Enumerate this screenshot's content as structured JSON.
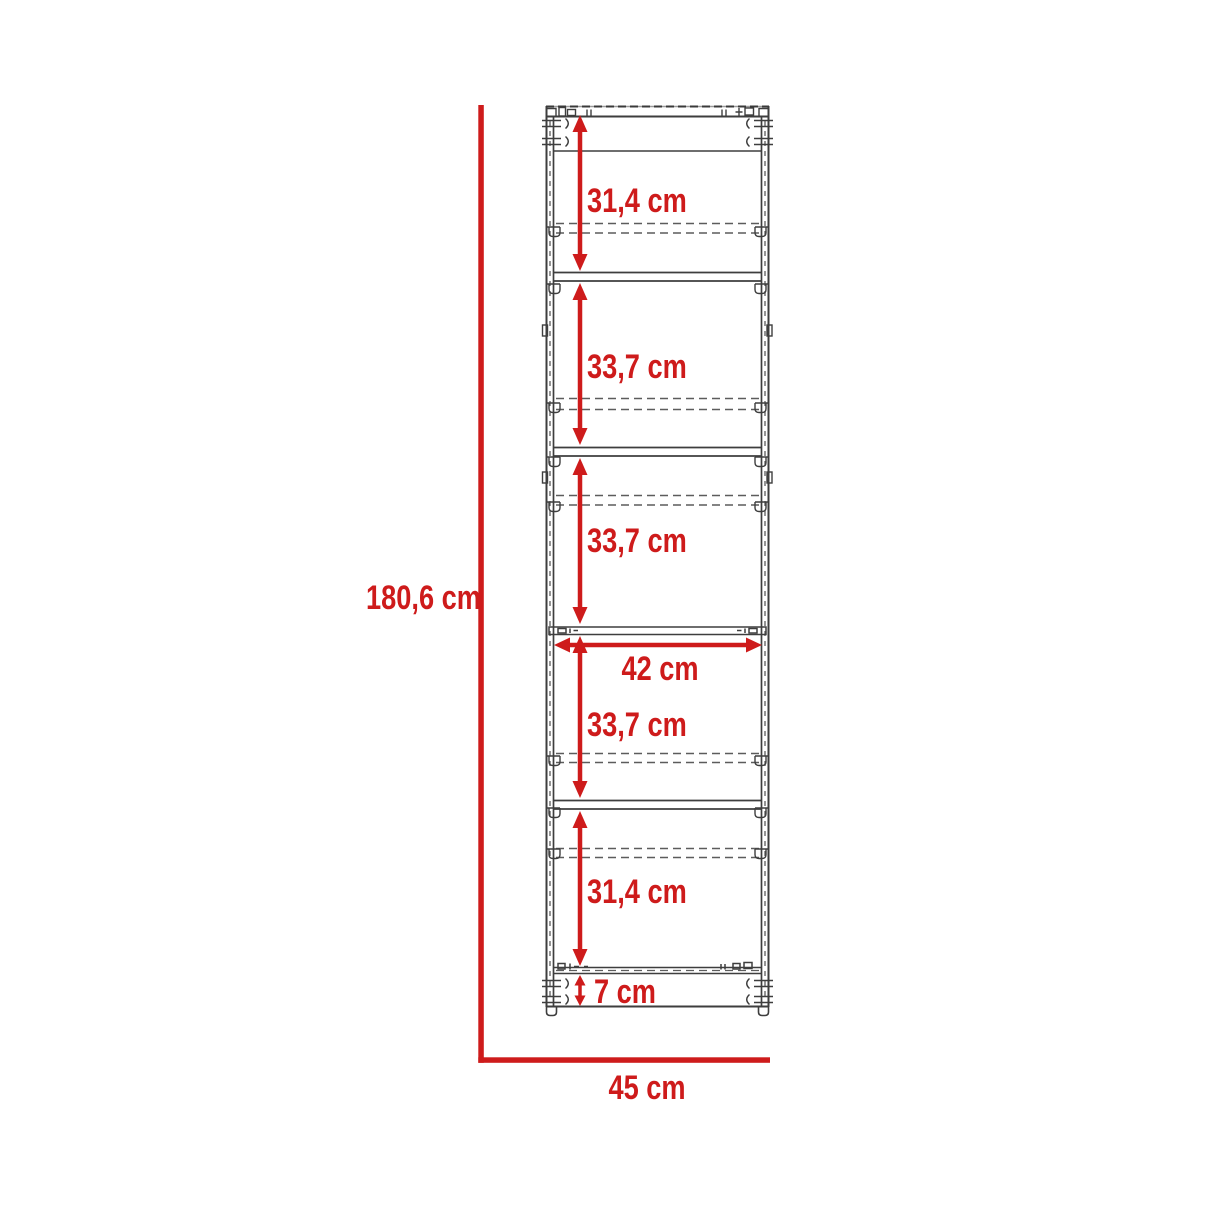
{
  "diagram": {
    "kind": "furniture-dimension-drawing",
    "subject": "tall cabinet front elevation",
    "unit": "cm",
    "overall_height": {
      "label": "180,6 cm",
      "value": 180.6
    },
    "overall_width": {
      "label": "45 cm",
      "value": 45
    },
    "interior_width": {
      "label": "42 cm",
      "value": 42
    },
    "plinth_height": {
      "label": "7 cm",
      "value": 7
    },
    "compartments": [
      {
        "name": "compartment-1",
        "label": "31,4 cm",
        "value": 31.4
      },
      {
        "name": "compartment-2",
        "label": "33,7 cm",
        "value": 33.7
      },
      {
        "name": "compartment-3",
        "label": "33,7 cm",
        "value": 33.7
      },
      {
        "name": "compartment-4",
        "label": "33,7 cm",
        "value": 33.7
      },
      {
        "name": "compartment-5",
        "label": "31,4 cm",
        "value": 31.4
      }
    ],
    "colors": {
      "dimension_red": "#ce1b1b",
      "line_dark": "#3e3e3e",
      "line_dashed": "#5c5c5c",
      "background": "#ffffff"
    }
  }
}
